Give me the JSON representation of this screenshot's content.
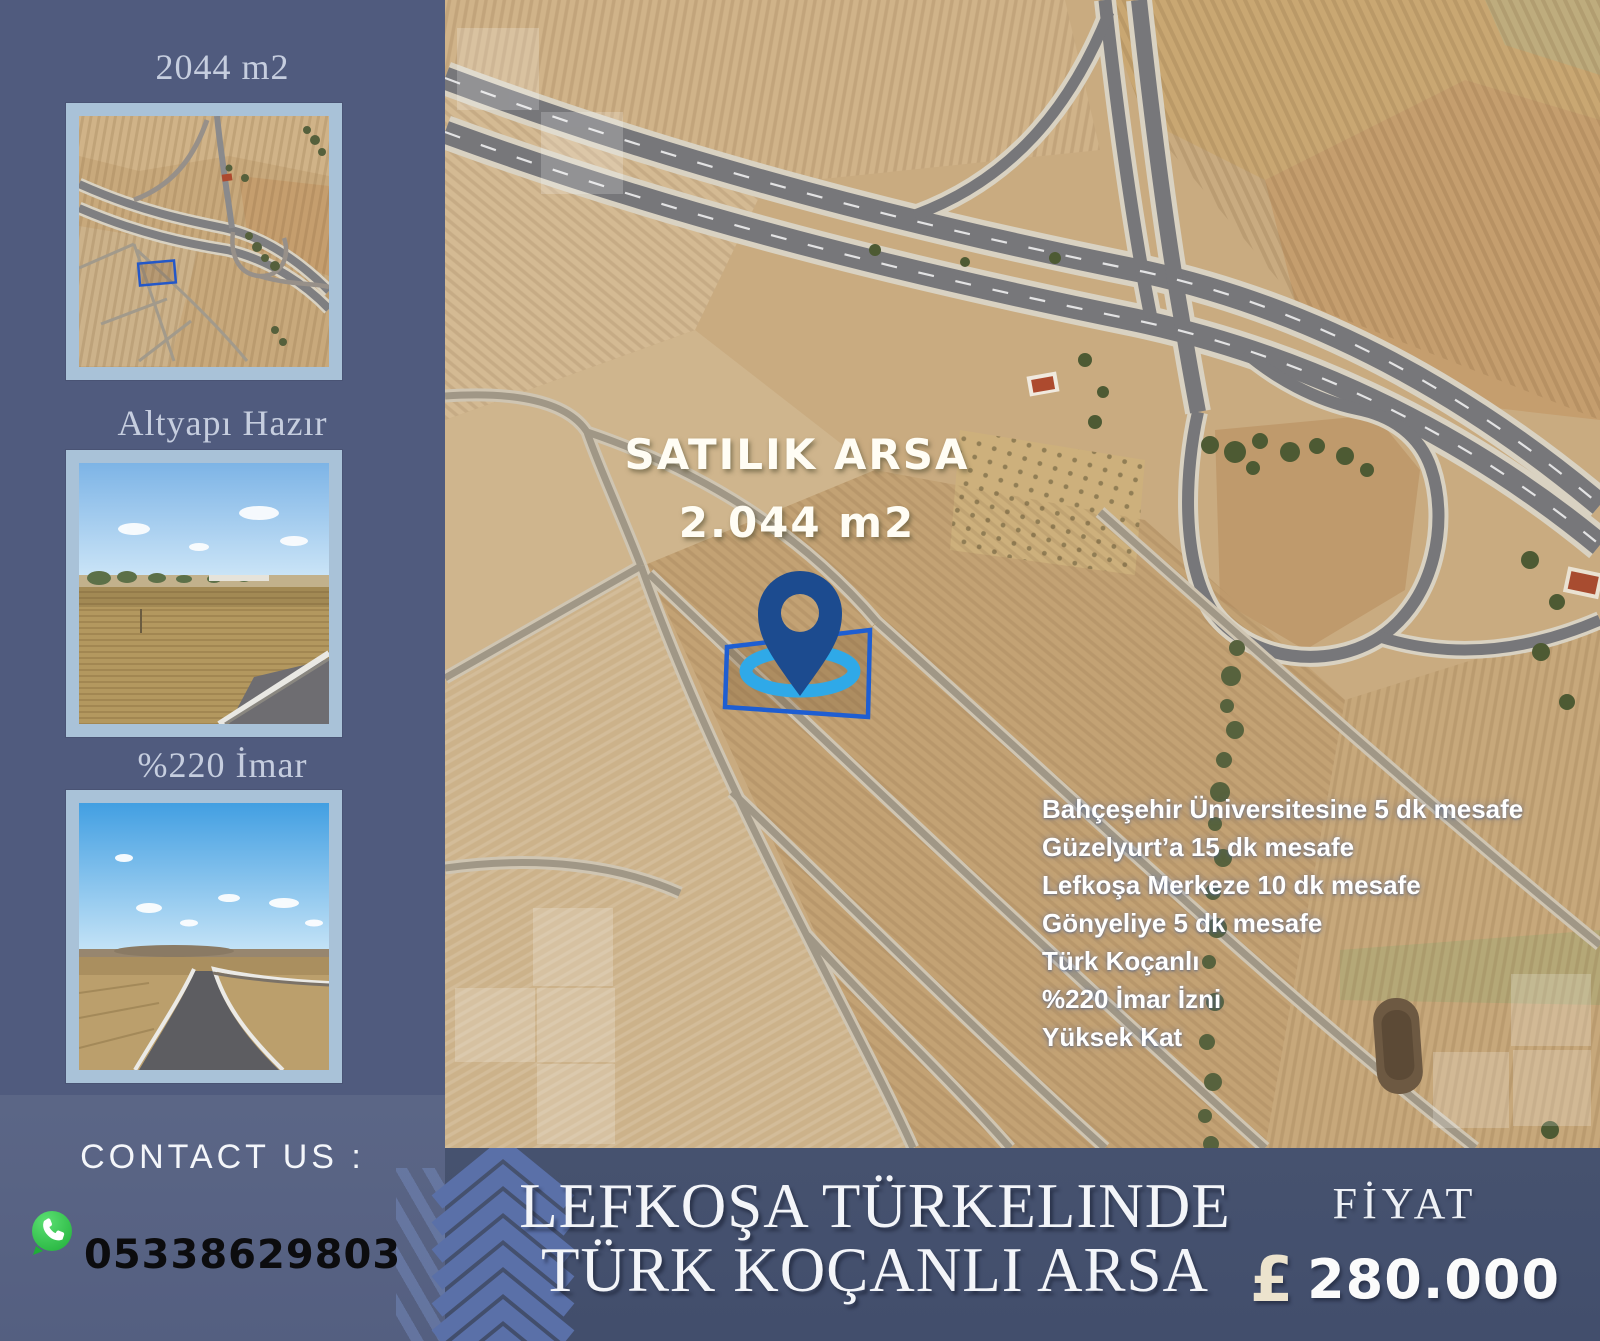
{
  "sidebar": {
    "cards": [
      {
        "label": "2044 m2",
        "image": "satellite-thumb"
      },
      {
        "label": "Altyapı Hazır",
        "image": "field-photo-thumb"
      },
      {
        "label": "%220 İmar",
        "image": "road-photo-thumb"
      }
    ],
    "contact": {
      "heading": "CONTACT US :",
      "phone": "05338629803",
      "icon": "whatsapp-icon"
    }
  },
  "map": {
    "listing_title": "SATILIK ARSA",
    "area": "2.044 m2",
    "pin_icon": "location-pin-icon",
    "features": [
      "Bahçeşehir Üniversitesine 5 dk mesafe",
      "Güzelyurt’a 15 dk mesafe",
      "Lefkoşa Merkeze 10 dk mesafe",
      "Gönyeliye 5 dk mesafe",
      "Türk Koçanlı",
      "%220 İmar İzni",
      "Yüksek Kat"
    ]
  },
  "footer": {
    "title_line1": "LEFKOŞA TÜRKELINDE",
    "title_line2": "TÜRK KOÇANLI ARSA",
    "price_label": "FİYAT",
    "currency_symbol": "£",
    "price": "280.000"
  },
  "colors": {
    "sidebar_bg": "#505b7e",
    "footer_bg": "#44506e",
    "thumb_border": "#a9c2d8",
    "map_base": "#c9ab80",
    "pin": "#1c4b8f",
    "ring": "#2fa9e8",
    "plot_outline": "#1e5ed2",
    "whatsapp_green": "#2bb741",
    "chevron": "#5a70a8"
  }
}
